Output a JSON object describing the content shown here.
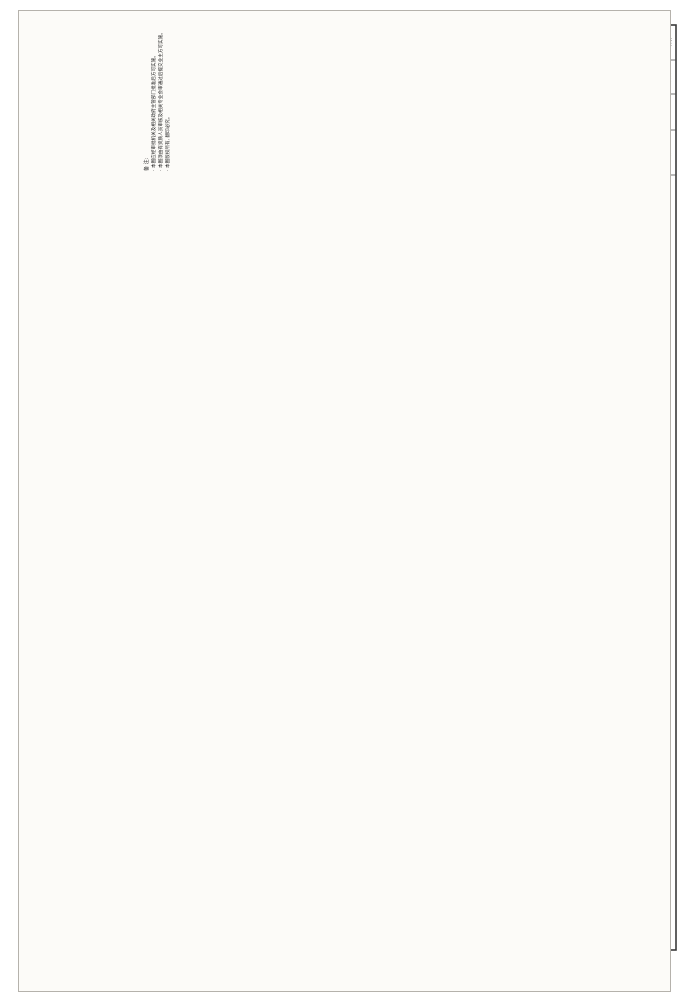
{
  "sheet": {
    "type": "scanned construction drawing",
    "orientation": "landscape content rotated on portrait scan"
  },
  "title_block": {
    "design_unit_label": "设计单位",
    "notes_title": "备 注:",
    "notes": [
      "本图应经审批机关及相关政府主管部门批准后方可实施。",
      "本图须由有资质人员审核及相关专业会审通过后提交业主方可实施。",
      "本图版权所有, 翻印必究。"
    ],
    "review_unit_label": "施工图审查批准单位:",
    "review_cert_label": "施工图审查合格证号:",
    "seal_label": "图纸专用章:",
    "signature_labels": [
      "审 定",
      "审 核",
      "项目负责人",
      "专业负责人",
      "校 对",
      "设 计"
    ],
    "figure_name_label": "图名:",
    "figure_names": [
      "三层电气平面图",
      "三层弱电平面图"
    ],
    "stage_value": "施工图",
    "page_label": "第 页",
    "pages_label": "共 页",
    "field_labels_teal": [
      "设计阶段",
      "图纸编号",
      "设计日期"
    ],
    "drawing_number": "电施-05",
    "design_date": "2013.04",
    "field_labels_bottom": [
      "工程编号",
      "图 别",
      "日 期"
    ]
  },
  "plans": [
    {
      "title": "三层弱电平面图 1:100",
      "type": "weak current (telecom/TV) plan"
    },
    {
      "title": "三层电气平面图 1:100",
      "type": "electrical power/lighting plan"
    }
  ],
  "axes": {
    "horizontal": [
      "D",
      "C",
      "B",
      "A"
    ],
    "vertical": [
      "4",
      "3",
      "2"
    ]
  },
  "dimensions_mm": {
    "top_chain": {
      "segments": [
        200,
        3300,
        3900,
        5400,
        1400
      ],
      "total": 14200
    },
    "bottom_chain": {
      "segments": [
        200,
        3300,
        3900,
        5400,
        2600
      ],
      "total": 15400
    },
    "side_chain": {
      "segments": [
        200,
        5700,
        4000,
        1700
      ],
      "total": 11600
    }
  },
  "level_mark": "7.300",
  "room_labels": [
    "主卧",
    "卧室",
    "起居厅",
    "露台",
    "采光顶",
    "阳台",
    "雨篷"
  ],
  "weak_current_outlets": [
    "TP",
    "TV",
    "TP+TO+TV",
    "TP+TO"
  ],
  "bottom_table": {
    "column_labels": [
      "专 业",
      "姓 名",
      "日 期"
    ],
    "disciplines": [
      "建 筑",
      "结 构",
      "电 气",
      "给排水"
    ]
  },
  "colors": {
    "paper": "#fcfbf8",
    "line": "#2e2e2e",
    "teal_label": "#1e7f7f",
    "dim_text": "#222222"
  },
  "render": {
    "plan_offsets": [
      0,
      360
    ],
    "plan_titles": [
      [
        "三层弱电平面图 1:100",
        565,
        338
      ],
      [
        "三层电气平面图 1:100",
        565,
        700
      ]
    ],
    "plan_labels": [
      [
        "主卧",
        248,
        271,
        -90,
        5
      ],
      [
        "卧室",
        250,
        372,
        -90,
        5
      ],
      [
        "卧室",
        360,
        371,
        -90,
        5
      ],
      [
        "起居厅",
        392,
        291,
        -90,
        5
      ],
      [
        "露台",
        420,
        293,
        -90,
        5.5
      ],
      [
        "采光顶",
        452,
        288,
        -90,
        4.2
      ],
      [
        "露台",
        424,
        374,
        -90,
        5.5
      ],
      [
        "阳台",
        278,
        416,
        -90,
        5
      ],
      [
        "7.300",
        371,
        287,
        -90,
        4.6
      ],
      [
        "采光顶",
        281,
        452,
        -90,
        4
      ],
      [
        "雨篷",
        366,
        449,
        -90,
        4
      ]
    ],
    "upper_labels": [
      [
        "TP",
        257,
        283,
        0,
        4.2
      ],
      [
        "TP+TO+TV",
        243,
        304,
        0,
        3.8
      ],
      [
        "TV",
        304,
        357,
        0,
        3.8
      ],
      [
        "TP+TO",
        299,
        368,
        0,
        3.8
      ],
      [
        "TV",
        357,
        363,
        0,
        3.8
      ],
      [
        "TP+TO+TV",
        289,
        313,
        -42,
        3.8
      ]
    ],
    "static_labels": [
      [
        "设计单位",
        52,
        128,
        -90,
        4.6,
        "n"
      ],
      [
        "施工图审查批准单位:",
        203,
        103,
        -90,
        4.3,
        "n"
      ],
      [
        "施工图审查合格证号:",
        230,
        103,
        -90,
        4.3,
        "n"
      ],
      [
        "图纸专用章:",
        258,
        116,
        -90,
        4.3,
        "n"
      ],
      [
        "审 定",
        495,
        140,
        -90,
        4.2,
        "n"
      ],
      [
        "审 核",
        506,
        140,
        -90,
        4.2,
        "n"
      ],
      [
        "项目负责人",
        517,
        140,
        -90,
        3.8,
        "n"
      ],
      [
        "专业负责人",
        529,
        140,
        -90,
        3.8,
        "n"
      ],
      [
        "校 对",
        540,
        140,
        -90,
        4.2,
        "n"
      ],
      [
        "设 计",
        551,
        140,
        -90,
        4.2,
        "n"
      ],
      [
        "图名:",
        562,
        152,
        -90,
        4.2,
        "n"
      ],
      [
        "三层电气平面图",
        589,
        100,
        -90,
        6.2,
        "n"
      ],
      [
        "三层弱电平面图",
        603,
        100,
        -90,
        6.2,
        "n"
      ],
      [
        "施工图",
        642,
        42,
        -90,
        5,
        "n"
      ],
      [
        "第 页",
        659,
        42,
        -90,
        3.6,
        "n"
      ],
      [
        "共 页",
        670,
        42,
        -90,
        3.6,
        "n"
      ],
      [
        "设计阶段",
        639,
        77,
        -90,
        4,
        "t"
      ],
      [
        "图纸编号",
        654,
        77,
        -90,
        4,
        "t"
      ],
      [
        "设计日期",
        669,
        77,
        -90,
        4,
        "t"
      ],
      [
        "电施-05",
        654,
        112,
        -90,
        4.6,
        "n"
      ],
      [
        "2013.04",
        669,
        112,
        -90,
        4.6,
        "n"
      ],
      [
        "工程编号",
        639,
        152,
        -90,
        4,
        "n"
      ],
      [
        "图 别",
        654,
        152,
        -90,
        4,
        "n"
      ],
      [
        "日 期",
        669,
        152,
        -90,
        4,
        "n"
      ],
      [
        "专 业",
        57,
        943,
        -90,
        3.8,
        "n"
      ],
      [
        "姓 名",
        99,
        943,
        -90,
        3.8,
        "n"
      ],
      [
        "日 期",
        141,
        943,
        -90,
        3.8,
        "n"
      ],
      [
        "专 业",
        184,
        943,
        -90,
        3.8,
        "n"
      ],
      [
        "姓 名",
        226,
        943,
        -90,
        3.8,
        "n"
      ],
      [
        "建 筑",
        259,
        910,
        -90,
        3.4,
        "n"
      ],
      [
        "结 构",
        259,
        921,
        -90,
        3.4,
        "n"
      ],
      [
        "电 气",
        259,
        932,
        -90,
        3.4,
        "n"
      ],
      [
        "给排水",
        259,
        943,
        -90,
        3,
        "n"
      ]
    ],
    "chains": [
      {
        "o": "h",
        "p": 211,
        "t": [
          223,
          226,
          277,
          339,
          421,
          442
        ],
        "v": [
          "200",
          "3300",
          "3900",
          "5400",
          "1400"
        ]
      },
      {
        "o": "h",
        "p": 198,
        "t": [
          223,
          442
        ],
        "v": [
          "14200"
        ]
      },
      {
        "o": "h",
        "p": 469,
        "t": [
          223,
          226,
          277,
          339,
          421,
          460
        ],
        "v": [
          "200",
          "3300",
          "3900",
          "5400",
          "2600"
        ]
      },
      {
        "o": "h",
        "p": 482,
        "t": [
          223,
          460
        ],
        "v": [
          "15400"
        ]
      },
      {
        "o": "v",
        "p": 163,
        "t": [
          249,
          252,
          340,
          402,
          428
        ],
        "v": [
          "200",
          "5700",
          "4000",
          "1700"
        ]
      },
      {
        "o": "v",
        "p": 150,
        "t": [
          249,
          428
        ],
        "v": [
          "11600"
        ]
      },
      {
        "o": "v",
        "p": 484,
        "t": [
          249,
          252,
          340,
          402,
          428
        ],
        "v": [
          "200",
          "5700",
          "4000",
          "1700"
        ]
      },
      {
        "o": "v",
        "p": 497,
        "t": [
          249,
          428
        ],
        "v": [
          "11600"
        ]
      }
    ],
    "bubbles": {
      "h": {
        "letters": [
          "D",
          "C",
          "B",
          "A"
        ],
        "x": [
          226,
          277,
          339,
          421
        ],
        "rows": [
          {
            "y": 182,
            "s1": 189,
            "s2": 246
          },
          {
            "y": 497,
            "s1": 432,
            "s2": 490
          }
        ]
      },
      "v": {
        "letters": [
          "4",
          "3",
          "2"
        ],
        "y": [
          252,
          340,
          402
        ],
        "cols": [
          {
            "x": 138,
            "s1": 145,
            "s2": 223
          },
          {
            "x": 508,
            "s1": 450,
            "s2": 501
          }
        ]
      }
    },
    "lamps": [
      [
        247,
        630
      ],
      [
        247,
        728
      ],
      [
        290,
        690
      ],
      [
        324,
        712
      ],
      [
        358,
        728
      ],
      [
        371,
        650
      ],
      [
        306,
        634
      ],
      [
        281,
        758
      ]
    ],
    "outlets": [
      [
        228,
        640
      ],
      [
        228,
        700
      ],
      [
        276,
        618
      ],
      [
        340,
        612
      ],
      [
        394,
        660
      ],
      [
        394,
        700
      ],
      [
        240,
        766
      ],
      [
        360,
        766
      ]
    ]
  }
}
